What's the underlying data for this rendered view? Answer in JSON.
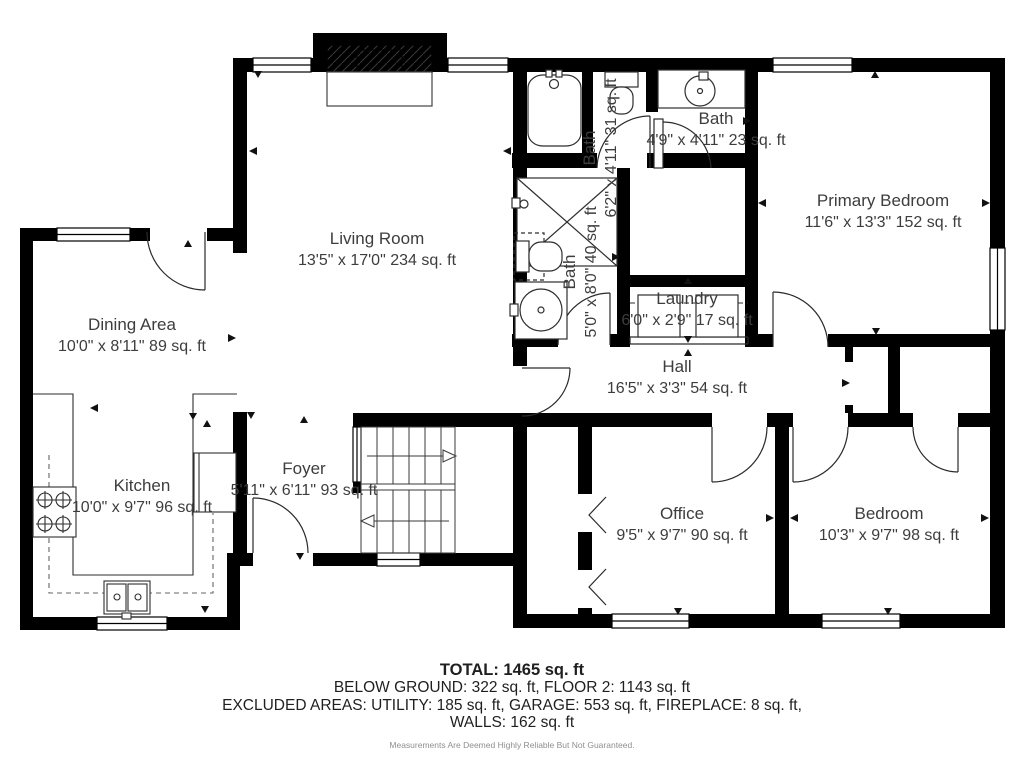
{
  "plan": {
    "rooms": [
      {
        "id": "living",
        "name": "Living Room",
        "dims": "13'5\" x 17'0\" 234 sq. ft"
      },
      {
        "id": "dining",
        "name": "Dining Area",
        "dims": "10'0\" x 8'11\" 89 sq. ft"
      },
      {
        "id": "kitchen",
        "name": "Kitchen",
        "dims": "10'0\" x 9'7\" 96 sq. ft"
      },
      {
        "id": "foyer",
        "name": "Foyer",
        "dims": "5'11\" x 6'11\" 93 sq. ft"
      },
      {
        "id": "hall",
        "name": "Hall",
        "dims": "16'5\" x 3'3\" 54 sq. ft"
      },
      {
        "id": "laundry",
        "name": "Laundry",
        "dims": "6'0\" x 2'9\" 17 sq. ft"
      },
      {
        "id": "bath-upper",
        "name": "Bath",
        "dims": "6'2\" x 4'11\" 31 sq. ft"
      },
      {
        "id": "bath-lower",
        "name": "Bath",
        "dims": "5'0\" x 8'0\" 40 sq. ft"
      },
      {
        "id": "bath-right",
        "name": "Bath",
        "dims": "4'9\" x 4'11\" 23 sq. ft"
      },
      {
        "id": "primary",
        "name": "Primary Bedroom",
        "dims": "11'6\" x 13'3\" 152 sq. ft"
      },
      {
        "id": "office",
        "name": "Office",
        "dims": "9'5\" x 9'7\" 90 sq. ft"
      },
      {
        "id": "bedroom",
        "name": "Bedroom",
        "dims": "10'3\" x 9'7\" 98 sq. ft"
      }
    ]
  },
  "footer": {
    "total": "TOTAL: 1465 sq. ft",
    "below_ground": "BELOW GROUND: 322 sq. ft, FLOOR 2: 1143 sq. ft",
    "excluded": "EXCLUDED AREAS: UTILITY: 185 sq. ft, GARAGE: 553 sq. ft, FIREPLACE: 8 sq. ft,",
    "walls": "WALLS: 162 sq. ft",
    "disclaimer": "Measurements Are Deemed Highly Reliable But Not Guaranteed."
  },
  "colors": {
    "wall": "#000000",
    "label_text": "#3d3d3d",
    "disclaimer_text": "#8f8f8f"
  }
}
